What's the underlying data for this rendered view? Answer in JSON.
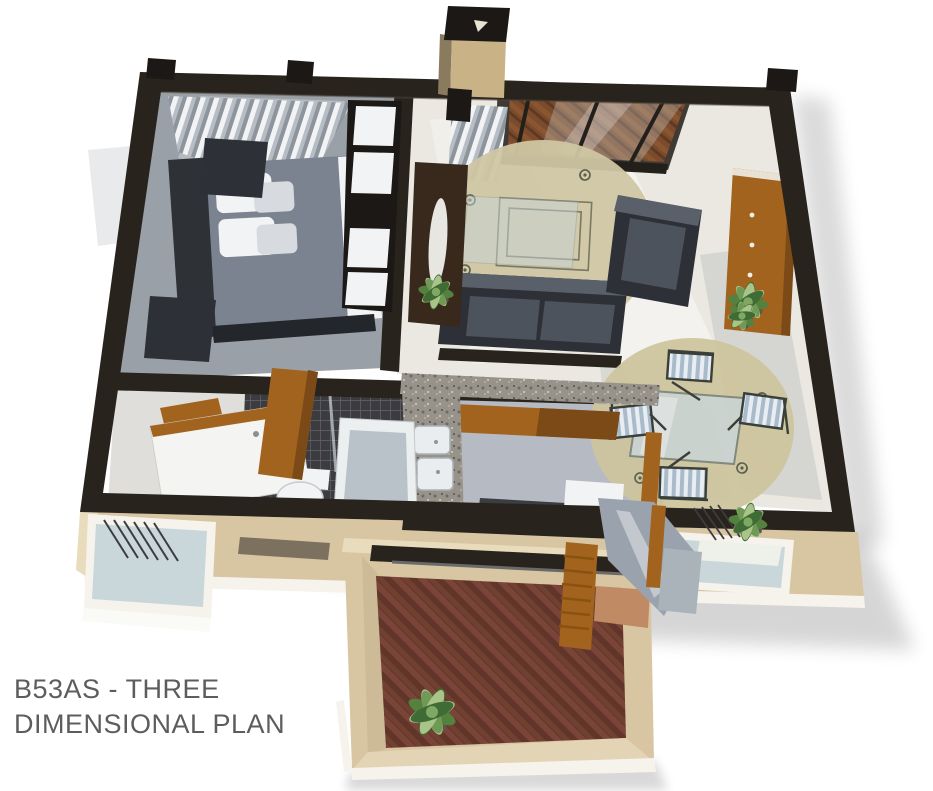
{
  "figure": {
    "kind": "3d-floor-plan-render",
    "plan_code": "B53AS"
  },
  "caption": {
    "line1": "B53AS - THREE",
    "line2": "DIMENSIONAL PLAN"
  },
  "rooms": [
    "bedroom",
    "living-room",
    "dining-area",
    "kitchen",
    "bathroom",
    "entry-hall",
    "patio",
    "deck"
  ],
  "palette": {
    "bg": "#ffffff",
    "text": "#5d5d5d",
    "wall": "#29231d",
    "wallDark": "#1b1815",
    "facade": "#d8c6a2",
    "facadeLight": "#e9dcbd",
    "trim": "#f6f3ec",
    "carpet": "#9aa0a7",
    "tile": "#eae8e0",
    "bathTile": "#3d3d41",
    "kitchenFloor": "#b6bbc3",
    "rugLiving": "#cfc6a2",
    "rugDining": "#cdc49e",
    "wood": "#a2631f",
    "woodDark": "#7c4a17",
    "brick": "#6b3a2f",
    "brickLight": "#c08a64",
    "sofa": "#2d3036",
    "cushion": "#4d535c",
    "bedDuvet": "#7b8290",
    "white": "#f2f3f4",
    "plant": "#55813f",
    "plantLight": "#a8c489",
    "glass": "#c9d6da"
  }
}
